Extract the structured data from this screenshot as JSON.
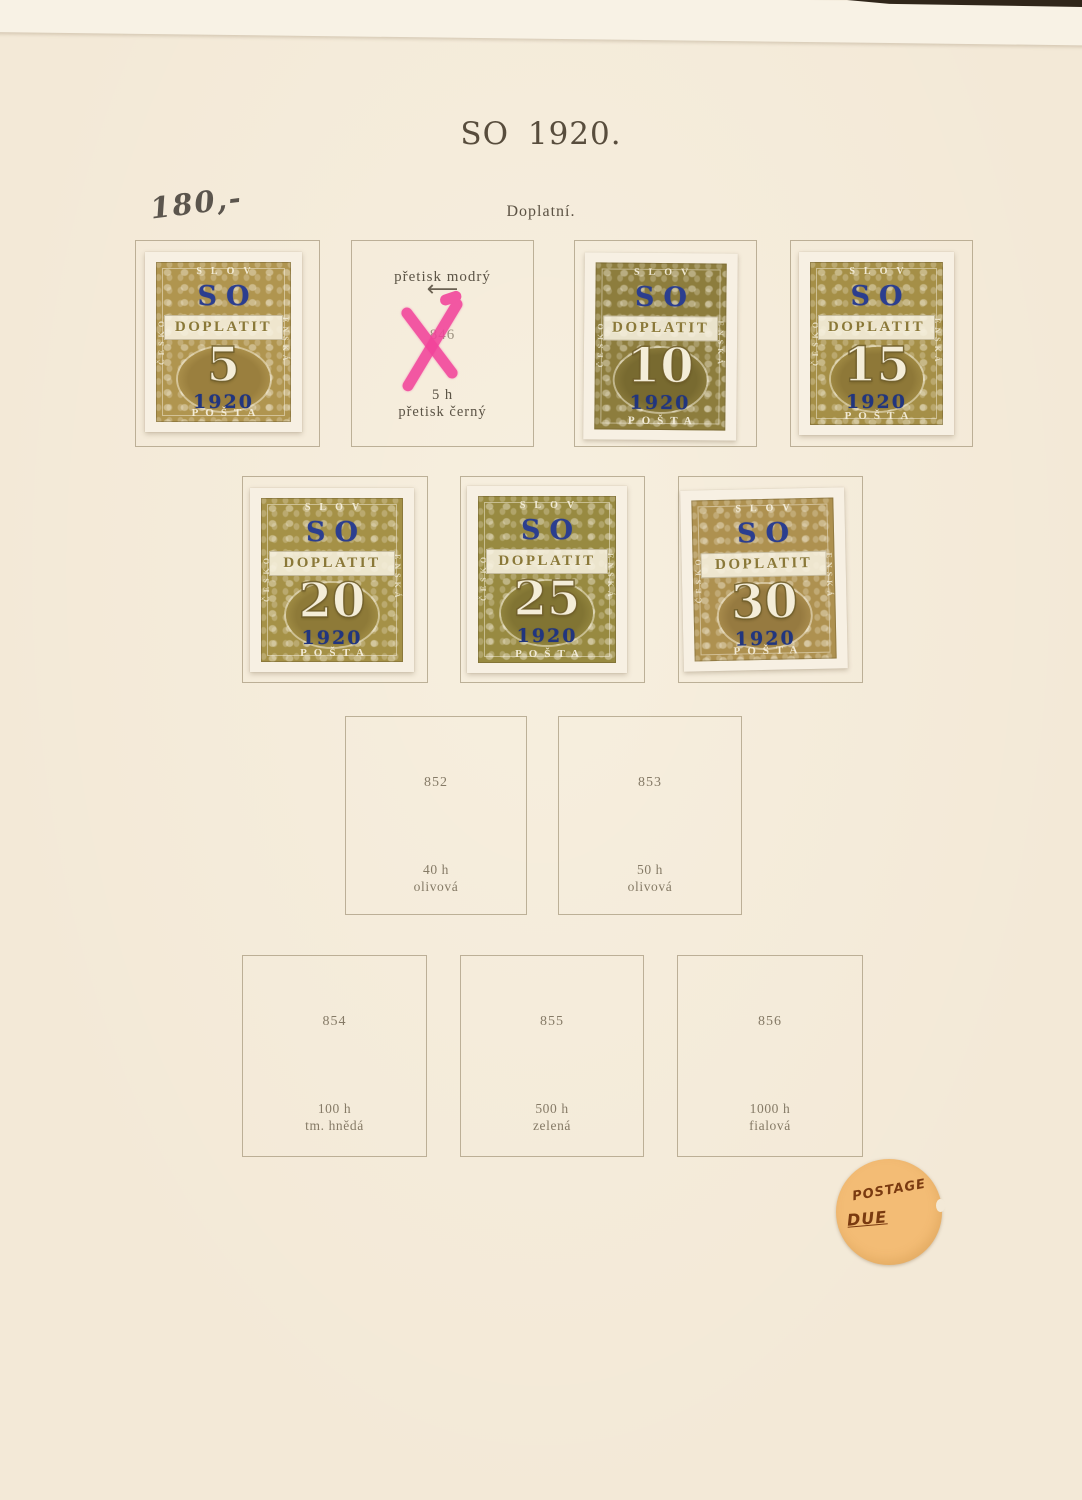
{
  "page": {
    "title": "SO 1920.",
    "subtitle": "Doplatní.",
    "handwritten_note": "180,-"
  },
  "stamp_design": {
    "overprint": "SO",
    "label": "DOPLATIT",
    "year": "1920",
    "top_text": "SLOV",
    "left_text": "ČESKO",
    "right_text": "ENSKÁ",
    "bottom_text": "POŠTA"
  },
  "stamps": [
    {
      "value": "5",
      "color": "#b0954f"
    },
    {
      "value": "10",
      "color": "#8d7d3d"
    },
    {
      "value": "15",
      "color": "#a58f47"
    },
    {
      "value": "20",
      "color": "#a59147"
    },
    {
      "value": "25",
      "color": "#988a41"
    },
    {
      "value": "30",
      "color": "#ae9150"
    }
  ],
  "annotation": {
    "overprint_color_note": "přetisk modrý",
    "arrow": "⟵",
    "catalog_number": "846",
    "denomination": "5 h",
    "overprint_black_note": "přetisk černý",
    "x_mark_color": "#f2439b"
  },
  "placeholders": [
    {
      "number": "852",
      "denomination": "40 h",
      "color_name": "olivová"
    },
    {
      "number": "853",
      "denomination": "50 h",
      "color_name": "olivová"
    },
    {
      "number": "854",
      "denomination": "100 h",
      "color_name": "tm. hnědá"
    },
    {
      "number": "855",
      "denomination": "500 h",
      "color_name": "zelená"
    },
    {
      "number": "856",
      "denomination": "1000 h",
      "color_name": "fialová"
    }
  ],
  "sticker": {
    "line1": "POSTAGE",
    "line2": "DUE"
  },
  "colors": {
    "page_bg": "#f3e9d7",
    "top_band": "#f8f2e5",
    "box_border": "#988a6e",
    "caption_text": "#857a66",
    "title_text": "#584d3d",
    "overprint_blue": "#2b3e8f",
    "year_blue": "#21357e",
    "x_mark_pink": "#f2439b",
    "sticker_bg": "#f3bc75",
    "sticker_ink": "#7a3a10"
  }
}
